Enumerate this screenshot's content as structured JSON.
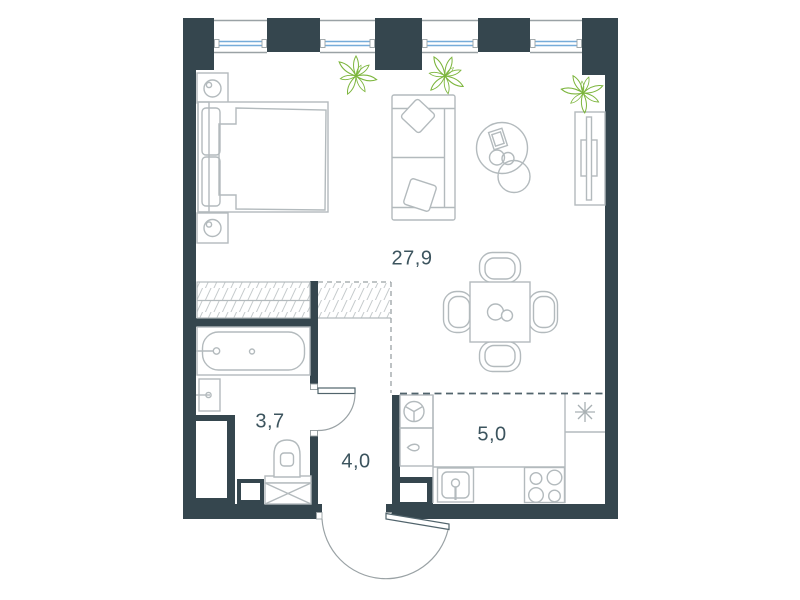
{
  "plan": {
    "name": "studio-apartment-floor-plan",
    "rooms": [
      {
        "id": "living-room",
        "area": "27,9"
      },
      {
        "id": "bathroom",
        "area": "3,7"
      },
      {
        "id": "hallway",
        "area": "4,0"
      },
      {
        "id": "kitchen",
        "area": "5,0"
      }
    ],
    "symbols": [
      "double-bed",
      "nightstand",
      "table-lamp",
      "sofa",
      "throw-pillow",
      "coffee-table",
      "magazine",
      "tv-console",
      "dining-table",
      "dining-chair",
      "plate",
      "plant",
      "wardrobe-hatched",
      "bathtub",
      "faucet",
      "wash-basin",
      "toilet",
      "washing-machine",
      "duct-shaft",
      "kitchen-sink",
      "stove-burners",
      "fridge-cabinet",
      "extractor-vent",
      "water-drop",
      "asterisk-fixture",
      "window-glazing",
      "entrance-door-swing",
      "bathroom-door-swing"
    ],
    "colors": {
      "wall": "#35464e",
      "furniture_line": "#b3babd",
      "hatch_line": "#c6cbcd",
      "glazing_blue": "#76acd9",
      "plant_green": "#7cb53c",
      "label_text": "#3c545e",
      "zone_dash_dark": "#51646c",
      "zone_dash_gray": "#9aa2a5"
    }
  }
}
